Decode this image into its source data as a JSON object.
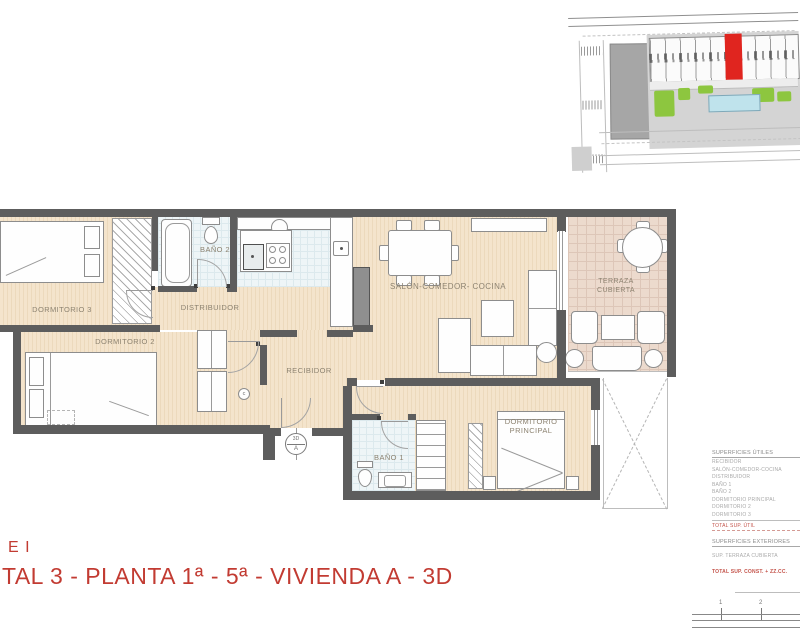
{
  "title_block": {
    "line1": "E I",
    "line2": "TAL 3 - PLANTA 1ª - 5ª - VIVIENDA A - 3D"
  },
  "rooms": {
    "dormitorio3": "DORMITORIO 3",
    "dormitorio2": "DORMITORIO 2",
    "bano2": "BAÑO 2",
    "distribuidor": "DISTRIBUIDOR",
    "recibidor": "RECIBIDOR",
    "salon": "SALÓN-COMEDOR- COCINA",
    "terraza": "TERRAZA CUBIERTA",
    "bano1": "BAÑO 1",
    "principal": "DORMITORIO PRINCIPAL"
  },
  "markers": {
    "camera_top": "3D",
    "camera_bottom": "A",
    "c_mark": "c"
  },
  "legend": {
    "utiles_header": "SUPERFICIES ÚTILES",
    "utiles_items": [
      "RECIBIDOR",
      "SALÓN-COMEDOR-COCINA",
      "DISTRIBUIDOR",
      "BAÑO 1",
      "BAÑO 2",
      "DORMITORIO PRINCIPAL",
      "DORMITORIO 2",
      "DORMITORIO 3"
    ],
    "total_util": "TOTAL SUP. ÚTIL",
    "exteriores_header": "SUPERFICIES EXTERIORES",
    "exteriores_items": [
      "SUP. TERRAZA CUBIERTA"
    ],
    "total_const": "TOTAL SUP. CONST. + ZZ.CC."
  },
  "scale_bar": {
    "ticks": [
      "1",
      "2"
    ]
  },
  "colors": {
    "accent_red": "#c23b32",
    "legend_red": "#c4544b",
    "site_highlight_red": "#e0251f",
    "pool_blue": "#bfe3ec",
    "landscape_green": "#8dc63f",
    "wall_gray": "#5d5d5d",
    "wood_floor": "#f3e3cb",
    "bath_tile": "#eef5f7",
    "terrace_tile": "#ecdacd"
  }
}
